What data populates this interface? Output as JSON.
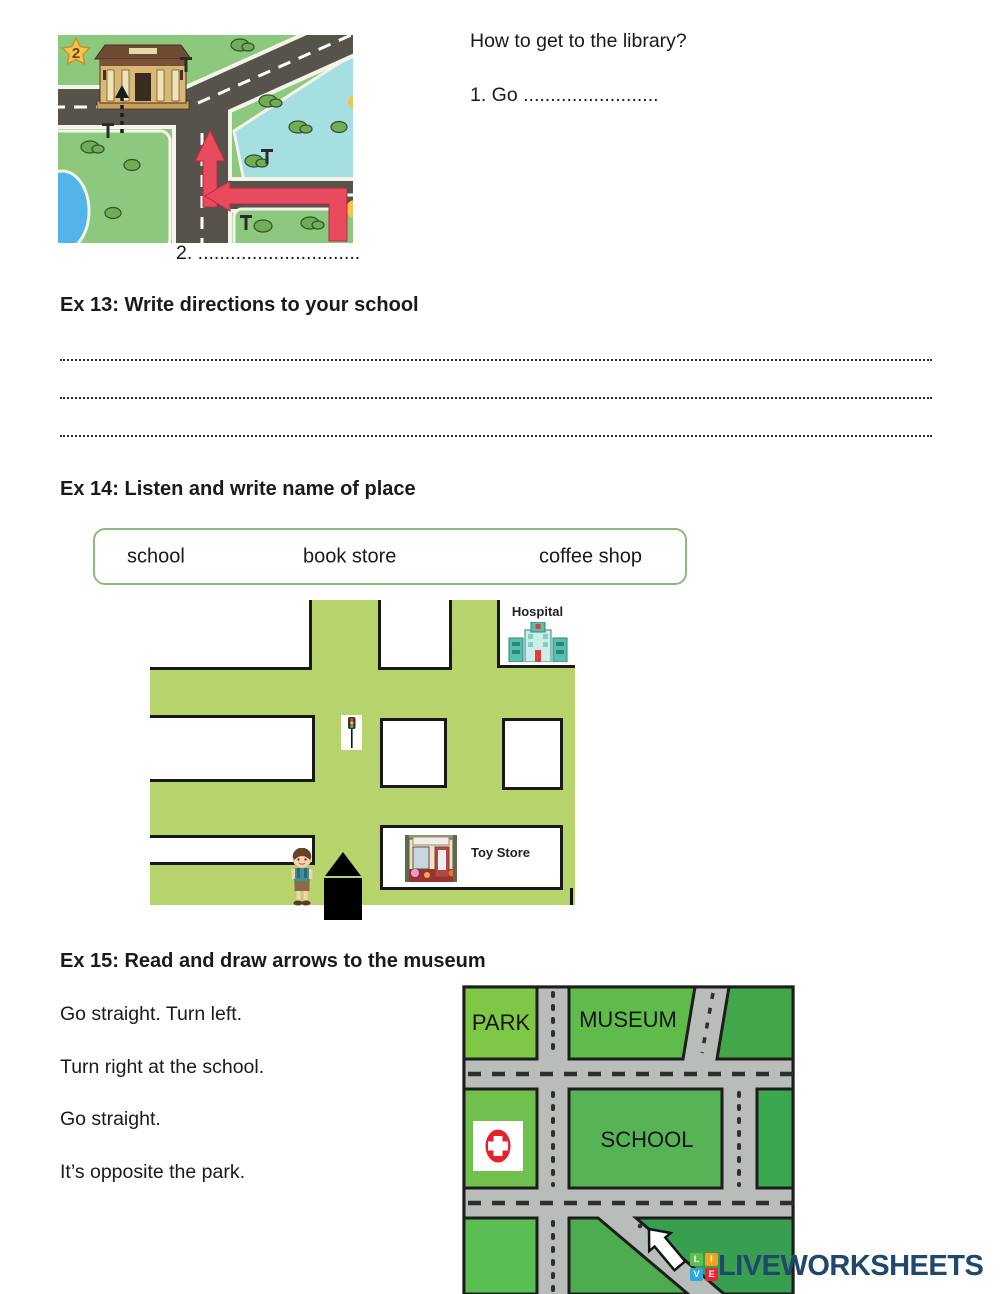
{
  "library_exercise": {
    "map_badge": "2",
    "question": "How to get to the library?",
    "answer_line_1": "1. Go .........................",
    "answer_line_2": "2. .............................."
  },
  "ex13": {
    "title": "Ex 13: Write directions to your school",
    "answer_line_count": "3"
  },
  "ex14": {
    "title": "Ex 14: Listen and write name of place",
    "word_bank": [
      "school",
      "book store",
      "coffee shop"
    ],
    "hospital_label": "Hospital",
    "toy_store_label": "Toy Store"
  },
  "ex15": {
    "title": "Ex 15: Read and draw arrows to the museum",
    "instructions": [
      "Go straight. Turn left.",
      "Turn right at the school.",
      "Go straight.",
      "It’s opposite the park."
    ],
    "park_label": "PARK",
    "museum_label": "MUSEUM",
    "school_label": "SCHOOL"
  },
  "footer": {
    "tiles": [
      {
        "letter": "L",
        "color": "#5fbf4e"
      },
      {
        "letter": "I",
        "color": "#f7a01d"
      },
      {
        "letter": "V",
        "color": "#2ba9e0"
      },
      {
        "letter": "E",
        "color": "#ea2330"
      }
    ],
    "brand": "LIVEWORKSHEETS"
  },
  "colors": {
    "brand_navy": "#20486e",
    "word_box_border": "#8cba7c",
    "map1_grass": "#8cc87e",
    "map1_road": "#56534b",
    "map1_water": "#a5dfe2",
    "arrow_red": "#e84b5e",
    "map2_green": "#b7d36b",
    "map3_road": "#b9bdb9",
    "map3_park_green": "#7ec845"
  }
}
